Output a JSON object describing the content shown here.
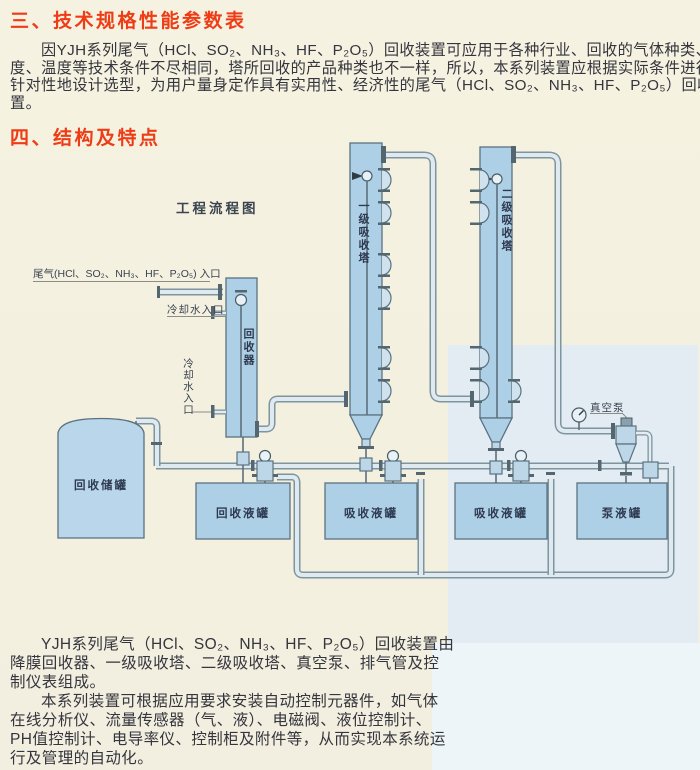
{
  "sections": {
    "h1": "三、技术规格性能参数表",
    "p1_lines": [
      "因YJH系列尾气（HCl、SO₂、NH₃、HF、P₂O₅）回收装置可应用于各种行业、回收的气体种类、浓",
      "度、温度等技术条件不尽相同，塔所回收的产品种类也不一样，所以，本系列装置应根据实际条件进行",
      "针对性地设计选型，为用户量身定作具有实用性、经济性的尾气（HCl、SO₂、NH₃、HF、P₂O₅）回收装",
      "置。"
    ],
    "h2": "四、结构及特点",
    "p2_lines": [
      "YJH系列尾气（HCl、SO₂、NH₃、HF、P₂O₅）回收装置由",
      "降膜回收器、一级吸收塔、二级吸收塔、真空泵、排气管及控",
      "制仪表组成。"
    ],
    "p3_lines": [
      "本系列装置可根据应用要求安装自动控制元器件，如气体",
      "在线分析仪、流量传感器（气、液）、电磁阀、液位控制计、",
      "PH值控制计、电导率仪、控制柜及附件等，从而实现本系统运",
      "行及管理的自动化。"
    ]
  },
  "diagram": {
    "title": "工程流程图",
    "labels": {
      "tail_gas_inlet": "尾气(HCl、SO₂、NH₃、HF、P₂O₅) 入口",
      "cooling_water_inlet_1": "冷却水入口",
      "cooling_water_inlet_2": "冷却水入口",
      "recovery_unit": "回收器",
      "tower1": "一级吸收塔",
      "tower2": "二级吸收塔",
      "vacuum_pump": "真空泵",
      "storage_tank": "回收储罐",
      "tank1": "回收液罐",
      "tank2": "吸收液罐",
      "tank3": "吸收液罐",
      "tank4": "泵液罐"
    },
    "colors": {
      "heading_red": "#ee3c16",
      "equipment_blue": "#aed0e7",
      "pipe_outline": "#7e949f",
      "page_cream": "#f5f1e0",
      "band_blue": "#e3ecf3"
    }
  }
}
